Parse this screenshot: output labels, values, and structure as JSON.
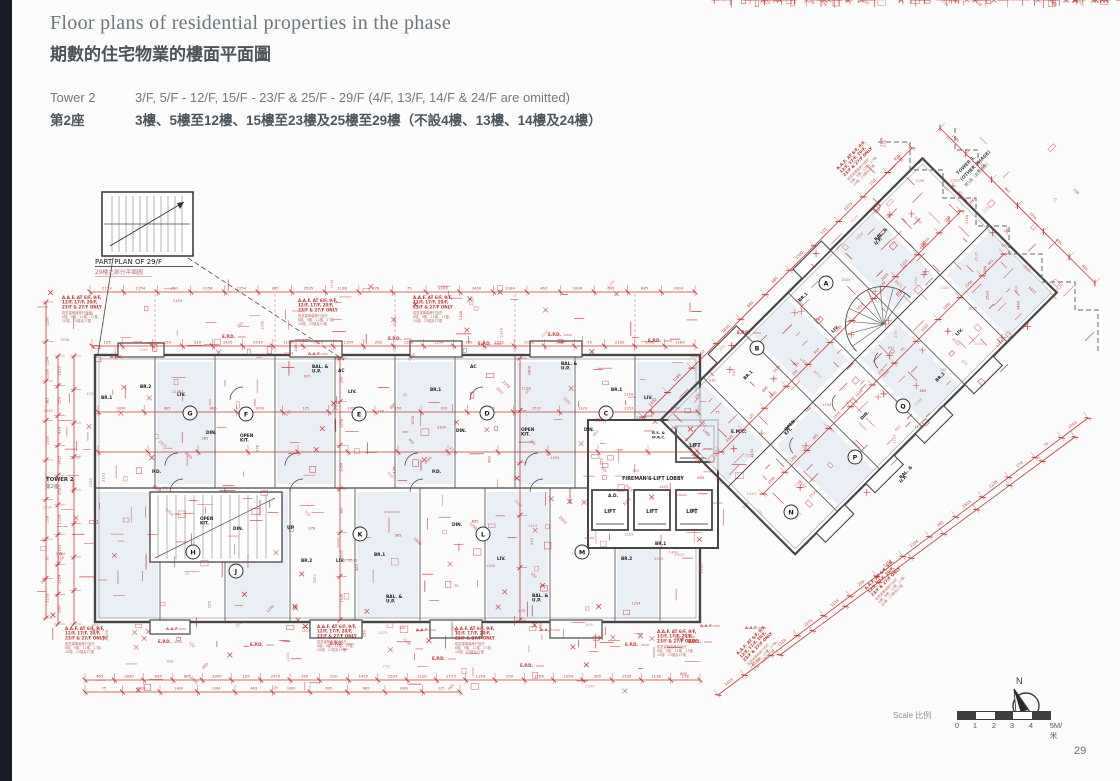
{
  "page": {
    "page_number": "29"
  },
  "header": {
    "title_en": "Floor plans of residential properties in the phase",
    "title_zh": "期數的住宅物業的樓面平面圖",
    "tower_label_en": "Tower 2",
    "tower_label_zh": "第2座",
    "floors_en": "3/F, 5/F - 12/F, 15/F - 23/F & 25/F - 29/F (4/F, 13/F, 14/F & 24/F are omitted)",
    "floors_zh": "3樓、5樓至12樓、15樓至23樓及25樓至29樓（不設4樓、13樓、14樓及24樓）"
  },
  "footer": {
    "scale_label": "Scale 比例",
    "scale_ticks": [
      "0",
      "1",
      "2",
      "3",
      "4",
      "5M/米"
    ],
    "north_label": "N"
  },
  "plan": {
    "colors": {
      "wall": "#454545",
      "wall_light": "#8d8d8d",
      "red": "#c0322e",
      "red_soft": "#bf6f6c",
      "tint": "#e4ebf2",
      "black": "#1f1f1f",
      "gray": "#5a5a5a"
    },
    "labels": {
      "part_plan_en": "PART PLAN OF 29/F",
      "part_plan_zh": "29樓之部分平面圖",
      "tower_marker_en": "TOWER 2",
      "tower_marker_zh": "第2座",
      "other_phase_l1": "TOWER 1",
      "other_phase_l2": "(OTHER PHASE)",
      "other_phase_zh": "第1座（其他期數）",
      "lift": "LIFT",
      "fireman_lobby": "FIREMAN'S LIFT LOBBY",
      "up": "UP",
      "epd": "E.P.D.",
      "aaf": "A.A.F.",
      "rs": "R.S. &",
      "mrc": "M.R.C."
    },
    "aaf_note_en": [
      "A.A.F. AT 6/F, 9/F,",
      "12/F, 17/F, 20/F,",
      "23/F & 27/F ONLY"
    ],
    "aaf_note_zh": [
      "鋁質建築裝飾只設於",
      "6樓、9樓、12樓、17樓、",
      "20樓、23樓及27樓"
    ],
    "units_main_top": [
      {
        "id": "G",
        "x": 190,
        "y": 413
      },
      {
        "id": "F",
        "x": 246,
        "y": 414
      },
      {
        "id": "E",
        "x": 359,
        "y": 414
      },
      {
        "id": "D",
        "x": 487,
        "y": 413
      },
      {
        "id": "C",
        "x": 606,
        "y": 413
      }
    ],
    "units_main_bottom": [
      {
        "id": "H",
        "x": 193,
        "y": 552
      },
      {
        "id": "J",
        "x": 236,
        "y": 571
      },
      {
        "id": "K",
        "x": 360,
        "y": 534
      },
      {
        "id": "L",
        "x": 483,
        "y": 534
      },
      {
        "id": "M",
        "x": 582,
        "y": 552
      }
    ],
    "units_wing": [
      {
        "id": "A",
        "x": 826,
        "y": 283
      },
      {
        "id": "B",
        "x": 757,
        "y": 348
      },
      {
        "id": "Q",
        "x": 903,
        "y": 406
      },
      {
        "id": "P",
        "x": 855,
        "y": 457
      },
      {
        "id": "N",
        "x": 791,
        "y": 512
      }
    ],
    "room_labels": [
      [
        "BR.1",
        101,
        399,
        0
      ],
      [
        "BR.2",
        140,
        388,
        0
      ],
      [
        "LIV.",
        177,
        396,
        0
      ],
      [
        "DIN.",
        206,
        434,
        0
      ],
      [
        "OPEN|KIT.",
        240,
        437,
        0
      ],
      [
        "BAL. &|U.P.",
        312,
        368,
        0
      ],
      [
        "LIV.",
        348,
        393,
        0
      ],
      [
        "BR.1",
        430,
        391,
        0
      ],
      [
        "DIN.",
        456,
        432,
        0
      ],
      [
        "OPEN|KIT.",
        521,
        431,
        0
      ],
      [
        "BAL. &|U.P.",
        561,
        365,
        0
      ],
      [
        "BR.1",
        611,
        391,
        0
      ],
      [
        "LIV.",
        644,
        399,
        0
      ],
      [
        "DIN.",
        584,
        431,
        0
      ],
      [
        "AC",
        338,
        372,
        0
      ],
      [
        "AC",
        470,
        368,
        0
      ],
      [
        "OPEN|KIT.",
        200,
        520,
        0
      ],
      [
        "DIN.",
        233,
        530,
        0
      ],
      [
        "BR.2",
        301,
        562,
        0
      ],
      [
        "LIV.",
        336,
        562,
        0
      ],
      [
        "BR.1",
        374,
        556,
        0
      ],
      [
        "BAL. &|U.P.",
        386,
        598,
        0
      ],
      [
        "DIN.",
        452,
        526,
        0
      ],
      [
        "LIV.",
        497,
        560,
        0
      ],
      [
        "BAL. &|U.P.",
        532,
        597,
        0
      ],
      [
        "BR.2",
        621,
        560,
        0
      ],
      [
        "BR.1",
        655,
        545,
        0
      ],
      [
        "P.D.",
        152,
        473,
        0
      ],
      [
        "P.D.",
        432,
        473,
        0
      ],
      [
        "A.D.",
        608,
        497,
        0
      ],
      [
        "E.M.C.",
        731,
        433,
        0
      ],
      [
        "BR.1",
        800,
        302,
        -45
      ],
      [
        "LIV.",
        833,
        333,
        -45
      ],
      [
        "OPEN|KIT.",
        786,
        431,
        -45
      ],
      [
        "DIN.",
        862,
        420,
        -45
      ],
      [
        "BAL. &|U.P.",
        901,
        479,
        -45
      ],
      [
        "BR.2",
        937,
        382,
        -45
      ],
      [
        "BAL. &|U.P.",
        876,
        241,
        -45
      ],
      [
        "LIV.",
        957,
        336,
        -45
      ],
      [
        "BR.1",
        745,
        380,
        -45
      ]
    ],
    "epd_points": [
      [
        222,
        338
      ],
      [
        388,
        340
      ],
      [
        478,
        345
      ],
      [
        548,
        336
      ],
      [
        648,
        342
      ],
      [
        737,
        334
      ],
      [
        158,
        643
      ],
      [
        250,
        646
      ],
      [
        330,
        645
      ],
      [
        432,
        660
      ],
      [
        520,
        667
      ],
      [
        625,
        646
      ],
      [
        688,
        643
      ]
    ],
    "aaf_points": [
      [
        110,
        358
      ],
      [
        308,
        355
      ],
      [
        166,
        630
      ],
      [
        416,
        631
      ],
      [
        540,
        631
      ],
      [
        700,
        627
      ],
      [
        745,
        629
      ]
    ],
    "note_points": [
      [
        62,
        299,
        0
      ],
      [
        298,
        302,
        0
      ],
      [
        413,
        299,
        0
      ],
      [
        65,
        630,
        0
      ],
      [
        317,
        628,
        0
      ],
      [
        455,
        630,
        0
      ],
      [
        657,
        633,
        0
      ],
      [
        838,
        170,
        -45
      ],
      [
        866,
        590,
        -45
      ],
      [
        738,
        655,
        -45
      ]
    ],
    "dims": [
      "2153",
      "1154",
      "250",
      "1258",
      "1254",
      "385",
      "2535",
      "1138",
      "278",
      "75",
      "2103",
      "1400",
      "1184",
      "463",
      "1830",
      "695",
      "885",
      "3300",
      "125",
      "2025",
      "150",
      "910",
      "1425",
      "2533",
      "1129"
    ]
  }
}
